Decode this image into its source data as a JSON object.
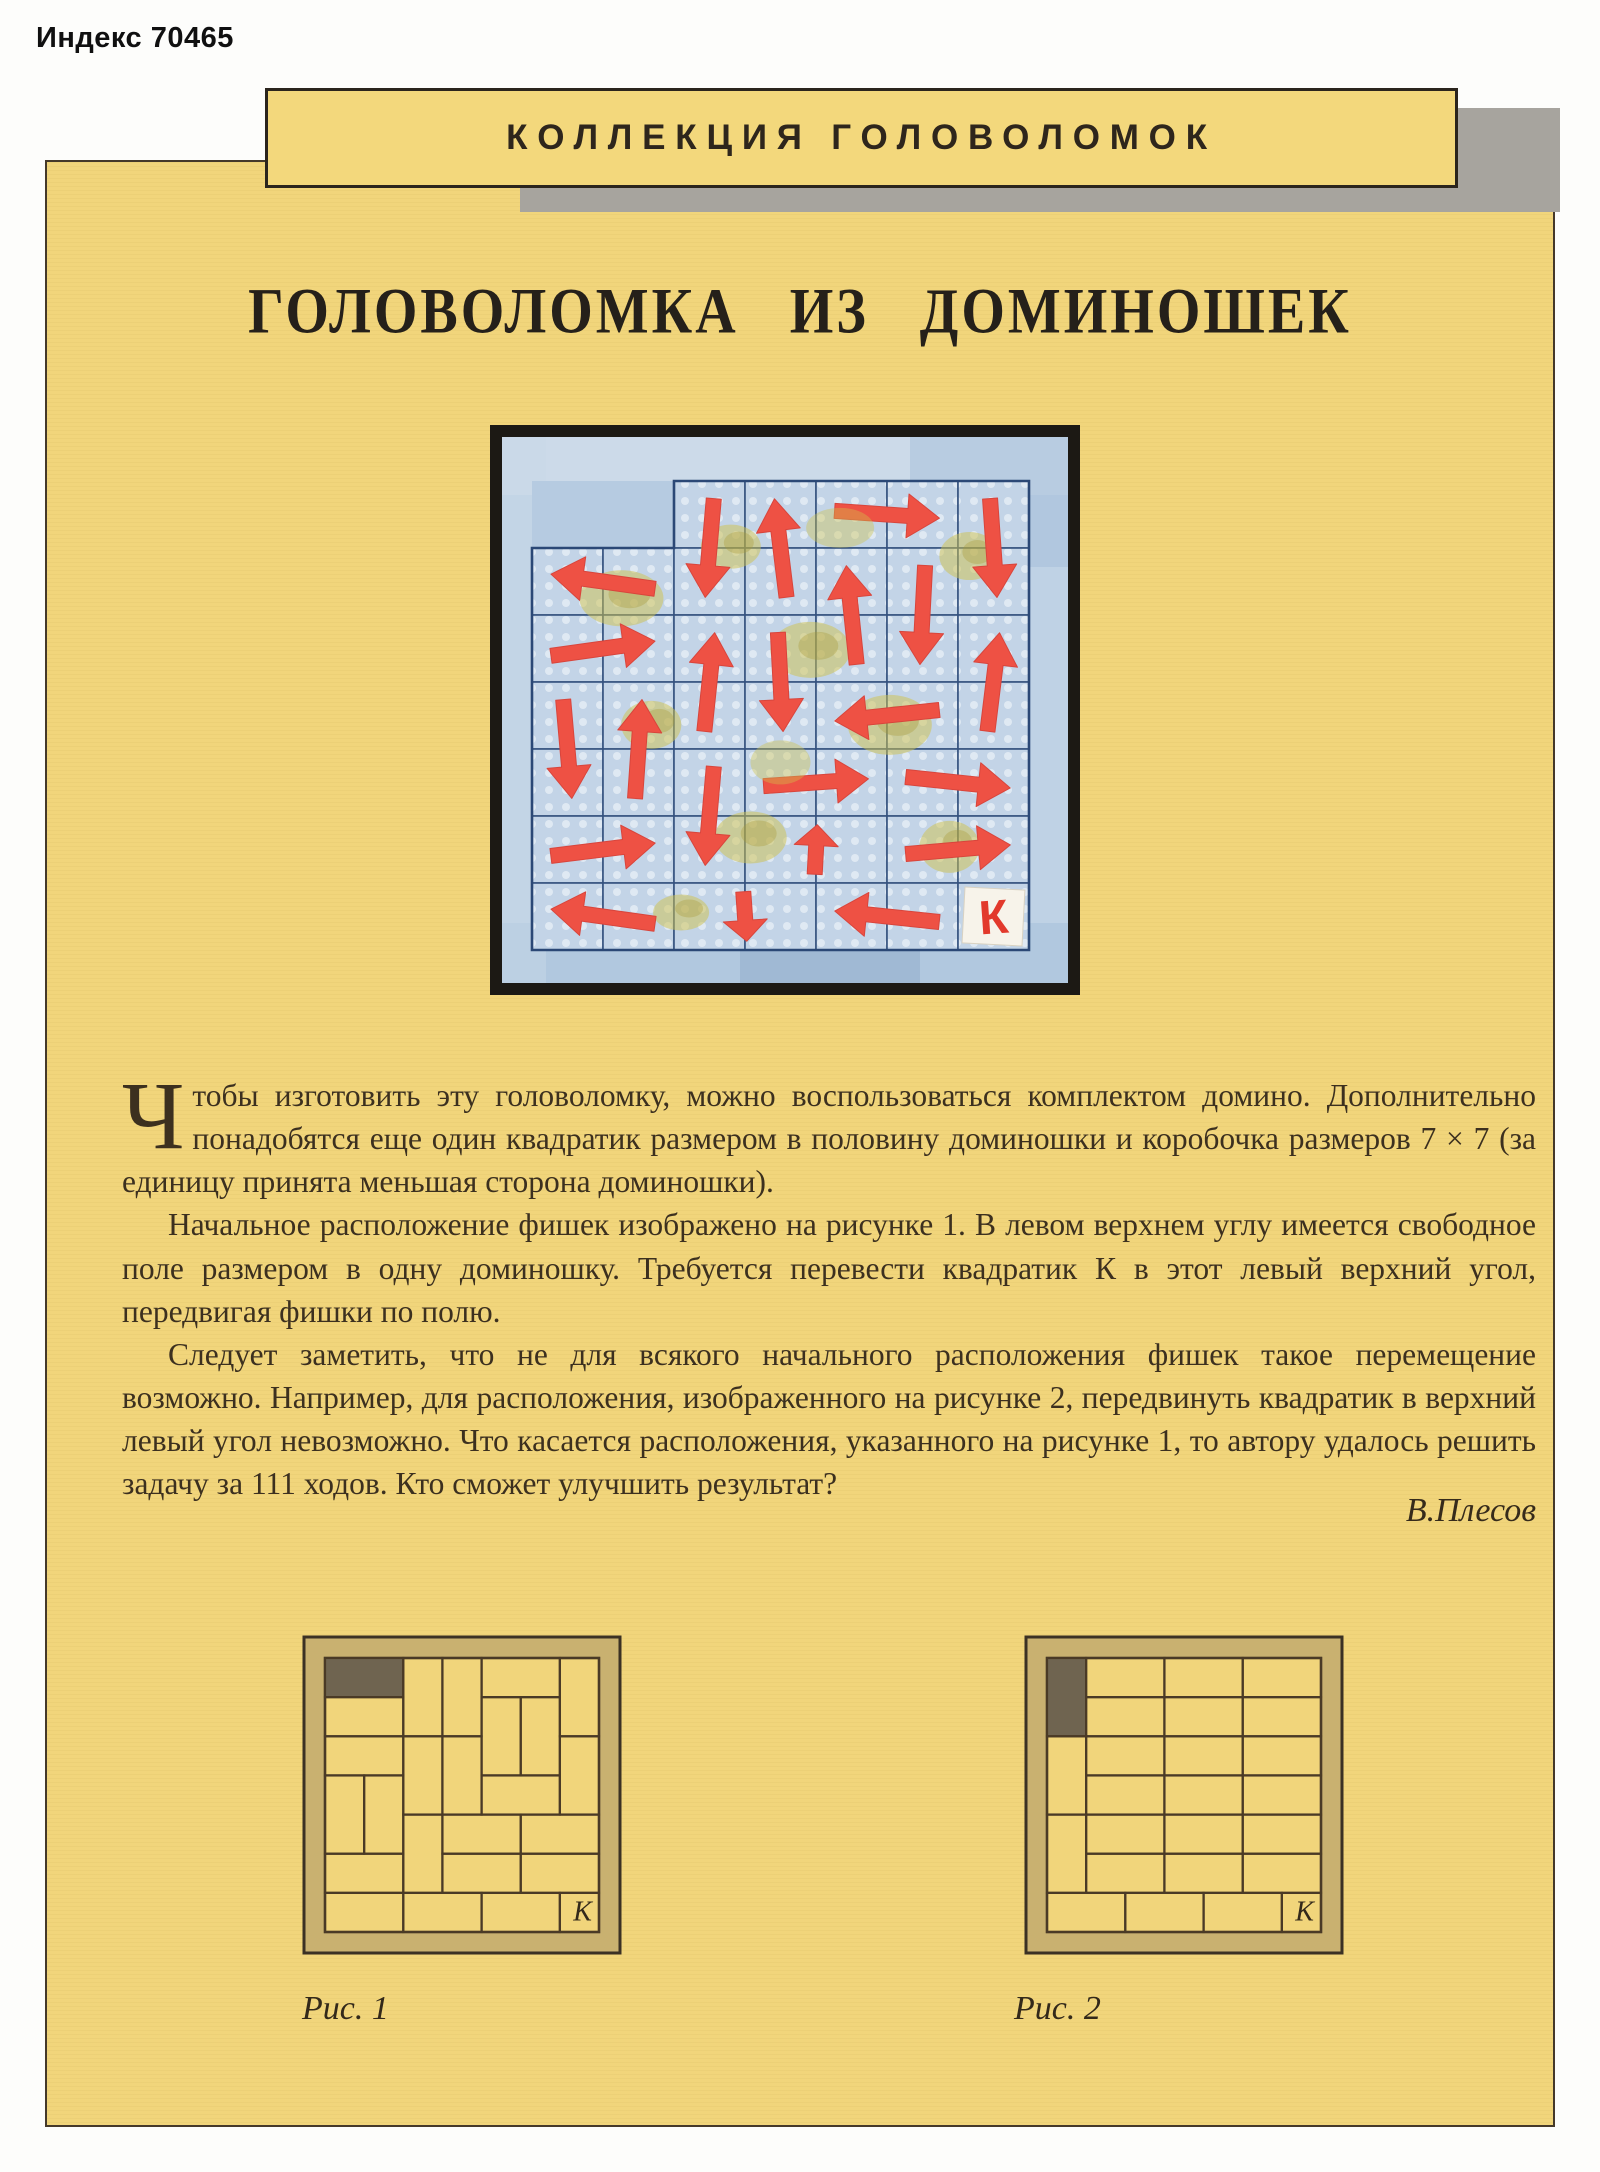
{
  "page": {
    "index_label": "Индекс 70465",
    "banner_title": "КОЛЛЕКЦИЯ ГОЛОВОЛОМОК",
    "article_title": "ГОЛОВОЛОМКА  ИЗ  ДОМИНОШЕК",
    "author": "В.Плесов"
  },
  "paragraphs": [
    {
      "dropcap": "Ч",
      "text": "тобы изготовить эту головоломку, можно воспользоваться комплектом домино. Дополнительно понадобятся еще один квадратик размером в половину доминошки и коробочка размеров 7 × 7 (за единицу принята меньшая сторона доминошки)."
    },
    {
      "dropcap": "",
      "text": "Начальное расположение фишек изображено на рисунке 1. В левом верхнем углу имеется свободное поле размером в одну доминошку. Требуется перевести квадратик К в этот левый верхний угол, передвигая фишки по полю."
    },
    {
      "dropcap": "",
      "text": "Следует заметить, что не для всякого начального расположения фишек такое перемещение возможно. Например, для расположения, изображенного на рисунке 2, передвинуть квадратик в верхний левый угол невозможно. Что касается расположения, указанного на рисунке 1, то автору удалось решить задачу за 111 ходов. Кто сможет улучшить результат?"
    }
  ],
  "illustration": {
    "k_label": "К",
    "grid": {
      "rows": 7,
      "cols": 7
    },
    "free_cells": [
      [
        1,
        1
      ],
      [
        1,
        2
      ]
    ],
    "k_cell": {
      "r": 7,
      "c": 7
    },
    "dominoes": [
      {
        "r": 1,
        "c": 3,
        "o": "v",
        "arrow": "down"
      },
      {
        "r": 1,
        "c": 4,
        "o": "v",
        "arrow": "up"
      },
      {
        "r": 1,
        "c": 5,
        "o": "h",
        "arrow": "right"
      },
      {
        "r": 1,
        "c": 7,
        "o": "v",
        "arrow": "down"
      },
      {
        "r": 2,
        "c": 1,
        "o": "h",
        "arrow": "left"
      },
      {
        "r": 2,
        "c": 5,
        "o": "v",
        "arrow": "up"
      },
      {
        "r": 2,
        "c": 6,
        "o": "v",
        "arrow": "down"
      },
      {
        "r": 3,
        "c": 1,
        "o": "h",
        "arrow": "right"
      },
      {
        "r": 3,
        "c": 3,
        "o": "v",
        "arrow": "up"
      },
      {
        "r": 3,
        "c": 4,
        "o": "v",
        "arrow": "down"
      },
      {
        "r": 3,
        "c": 7,
        "o": "v",
        "arrow": "up"
      },
      {
        "r": 4,
        "c": 1,
        "o": "v",
        "arrow": "down"
      },
      {
        "r": 4,
        "c": 2,
        "o": "v",
        "arrow": "up"
      },
      {
        "r": 4,
        "c": 5,
        "o": "h",
        "arrow": "left"
      },
      {
        "r": 5,
        "c": 3,
        "o": "v",
        "arrow": "down"
      },
      {
        "r": 5,
        "c": 4,
        "o": "h",
        "arrow": "right"
      },
      {
        "r": 5,
        "c": 6,
        "o": "h",
        "arrow": "right"
      },
      {
        "r": 6,
        "c": 1,
        "o": "h",
        "arrow": "right"
      },
      {
        "r": 6,
        "c": 4,
        "o": "h",
        "arrow": "up"
      },
      {
        "r": 6,
        "c": 6,
        "o": "h",
        "arrow": "right"
      },
      {
        "r": 7,
        "c": 1,
        "o": "h",
        "arrow": "left"
      },
      {
        "r": 7,
        "c": 3,
        "o": "h",
        "arrow": "down"
      },
      {
        "r": 7,
        "c": 5,
        "o": "h",
        "arrow": "left"
      }
    ]
  },
  "figures": [
    {
      "caption": "Рис. 1",
      "k_label": "К",
      "grid": {
        "rows": 7,
        "cols": 7
      },
      "free": {
        "r": 1,
        "c": 1,
        "o": "h"
      },
      "k_cell": {
        "r": 7,
        "c": 7
      },
      "dominoes": [
        {
          "r": 1,
          "c": 3,
          "o": "v"
        },
        {
          "r": 1,
          "c": 4,
          "o": "v"
        },
        {
          "r": 1,
          "c": 5,
          "o": "h"
        },
        {
          "r": 1,
          "c": 7,
          "o": "v"
        },
        {
          "r": 2,
          "c": 1,
          "o": "h"
        },
        {
          "r": 2,
          "c": 5,
          "o": "v"
        },
        {
          "r": 2,
          "c": 6,
          "o": "v"
        },
        {
          "r": 3,
          "c": 1,
          "o": "h"
        },
        {
          "r": 3,
          "c": 3,
          "o": "v"
        },
        {
          "r": 3,
          "c": 4,
          "o": "v"
        },
        {
          "r": 3,
          "c": 7,
          "o": "v"
        },
        {
          "r": 4,
          "c": 1,
          "o": "v"
        },
        {
          "r": 4,
          "c": 2,
          "o": "v"
        },
        {
          "r": 4,
          "c": 5,
          "o": "h"
        },
        {
          "r": 5,
          "c": 3,
          "o": "v"
        },
        {
          "r": 5,
          "c": 4,
          "o": "h"
        },
        {
          "r": 5,
          "c": 6,
          "o": "h"
        },
        {
          "r": 6,
          "c": 1,
          "o": "h"
        },
        {
          "r": 6,
          "c": 4,
          "o": "h"
        },
        {
          "r": 6,
          "c": 6,
          "o": "h"
        },
        {
          "r": 7,
          "c": 1,
          "o": "h"
        },
        {
          "r": 7,
          "c": 3,
          "o": "h"
        },
        {
          "r": 7,
          "c": 5,
          "o": "h"
        }
      ]
    },
    {
      "caption": "Рис. 2",
      "k_label": "К",
      "grid": {
        "rows": 7,
        "cols": 7
      },
      "free": {
        "r": 1,
        "c": 1,
        "o": "v"
      },
      "k_cell": {
        "r": 7,
        "c": 7
      },
      "dominoes": [
        {
          "r": 1,
          "c": 2,
          "o": "h"
        },
        {
          "r": 1,
          "c": 4,
          "o": "h"
        },
        {
          "r": 1,
          "c": 6,
          "o": "h"
        },
        {
          "r": 2,
          "c": 2,
          "o": "h"
        },
        {
          "r": 2,
          "c": 4,
          "o": "h"
        },
        {
          "r": 2,
          "c": 6,
          "o": "h"
        },
        {
          "r": 3,
          "c": 1,
          "o": "v"
        },
        {
          "r": 3,
          "c": 2,
          "o": "h"
        },
        {
          "r": 3,
          "c": 4,
          "o": "h"
        },
        {
          "r": 3,
          "c": 6,
          "o": "h"
        },
        {
          "r": 4,
          "c": 2,
          "o": "h"
        },
        {
          "r": 4,
          "c": 4,
          "o": "h"
        },
        {
          "r": 4,
          "c": 6,
          "o": "h"
        },
        {
          "r": 5,
          "c": 1,
          "o": "v"
        },
        {
          "r": 5,
          "c": 2,
          "o": "h"
        },
        {
          "r": 5,
          "c": 4,
          "o": "h"
        },
        {
          "r": 5,
          "c": 6,
          "o": "h"
        },
        {
          "r": 6,
          "c": 2,
          "o": "h"
        },
        {
          "r": 6,
          "c": 4,
          "o": "h"
        },
        {
          "r": 6,
          "c": 6,
          "o": "h"
        },
        {
          "r": 7,
          "c": 1,
          "o": "h"
        },
        {
          "r": 7,
          "c": 3,
          "o": "h"
        },
        {
          "r": 7,
          "c": 5,
          "o": "h"
        }
      ]
    }
  ],
  "colors": {
    "page_yellow": "#f1d57b",
    "banner_yellow": "#f3d87c",
    "shadow_gray": "#a7a49e",
    "fig_frame_tan": "#c9b170",
    "fig_line_brown": "#4a3a26",
    "free_block_dark": "#6f6450",
    "photo_frame_black": "#1c1914",
    "tile_blue": "#c3d4e7",
    "grid_blue": "#35527f",
    "arrow_red": "#ee5144",
    "stain_olive": "#cfc24c",
    "k_red": "#e2392c"
  }
}
